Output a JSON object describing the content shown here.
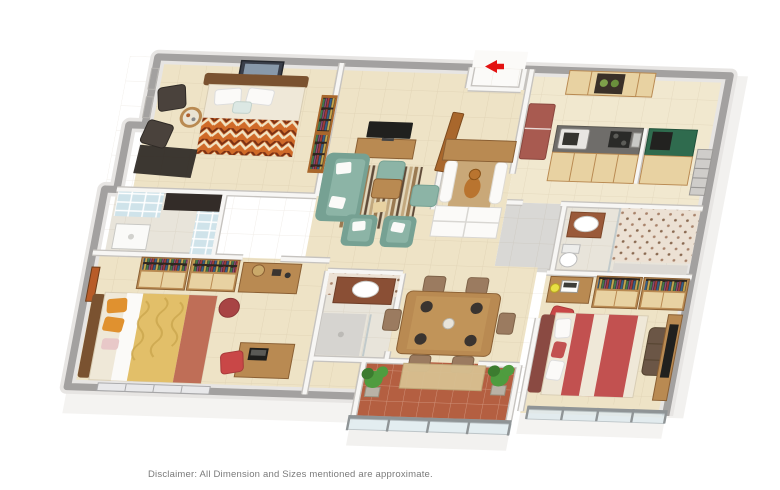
{
  "page": {
    "background": "#ffffff",
    "disclaimer": "Disclaimer: All Dimension and Sizes mentioned are approximate."
  },
  "floorplan": {
    "type": "3d-isometric-floor-plan",
    "entry": {
      "symbol": "red-arrow",
      "direction": "left"
    },
    "rooms": [
      {
        "id": "bedroom-2",
        "furniture": [
          "double-bed",
          "zigzag-blanket",
          "white-pillows",
          "accent-chair",
          "accent-chair",
          "round-side-table",
          "floor-mat",
          "wall-art",
          "window",
          "window",
          "bookshelf"
        ]
      },
      {
        "id": "bedroom-2-bathroom",
        "furniture": [
          "glass-brick-partition",
          "dark-counter",
          "shower-tray"
        ]
      },
      {
        "id": "living-room",
        "furniture": [
          "tv-unit",
          "television",
          "three-seat-sofa",
          "armchair",
          "armchair",
          "ottoman",
          "ottoman",
          "striped-rug",
          "coffee-table",
          "stool",
          "open-door"
        ]
      },
      {
        "id": "foyer",
        "furniture": [
          "entrance-recess",
          "entry-arrow"
        ]
      },
      {
        "id": "pooja-room",
        "furniture": [
          "wooden-canopy",
          "curtain",
          "curtain",
          "deity-idol",
          "drawer-base"
        ]
      },
      {
        "id": "kitchen",
        "furniture": [
          "refrigerator",
          "upper-cabinets",
          "storage-jars",
          "microwave",
          "hob",
          "sink",
          "granite-counter",
          "lower-cabinets"
        ]
      },
      {
        "id": "utility",
        "furniture": [
          "green-counter",
          "appliance",
          "lower-cabinets",
          "service-rack"
        ]
      },
      {
        "id": "bathroom-2",
        "furniture": [
          "vanity-washbasin",
          "toilet",
          "patterned-tiles",
          "shower-area"
        ]
      },
      {
        "id": "common-bathroom",
        "furniture": [
          "vanity-washbasin",
          "patterned-tiles",
          "shower-area",
          "glass-screen"
        ]
      },
      {
        "id": "bedroom-3",
        "furniture": [
          "double-bed",
          "yellow-blanket",
          "red-throw",
          "orange-pillows",
          "wardrobe",
          "wardrobe",
          "dresser",
          "pouf",
          "study-desk",
          "laptop",
          "red-chair",
          "wall-art",
          "window-band"
        ]
      },
      {
        "id": "dining",
        "furniture": [
          "dining-table",
          "dinner-plates",
          "dining-chair",
          "dining-chair",
          "dining-chair",
          "dining-chair",
          "dining-chair",
          "dining-chair"
        ]
      },
      {
        "id": "balcony",
        "furniture": [
          "terracotta-floor",
          "deck-mat",
          "planter",
          "planter",
          "glass-railing"
        ]
      },
      {
        "id": "master-bedroom",
        "furniture": [
          "double-bed",
          "red-blanket",
          "headboard",
          "bench",
          "wardrobe",
          "wardrobe",
          "tv-unit",
          "television",
          "desk",
          "laptop",
          "red-chair",
          "glass-railing"
        ]
      }
    ],
    "colors": {
      "wall-top": "#a3a1a0",
      "floor": "#eee3c6",
      "floor-light": "#f1e8cf",
      "floor-bath": "#e8e4da",
      "floor-gray": "#d9d8d5",
      "balcony-tile": "#b45f41",
      "balcony-mat": "#d8c091",
      "wood": "#b98a52",
      "wood-dark": "#7a5230",
      "wood-light": "#e8d2a2",
      "wood-red": "#a9672c",
      "sofa": "#8cb4a6",
      "sofa-dark": "#76a193",
      "bed-cream": "#efe8d8",
      "bed-orange": "#d06a28",
      "bed-yellow": "#e2bf69",
      "bed-red-throw": "#bf6e57",
      "pillow-orange": "#e0912f",
      "master-bed": "#c25150",
      "fridge": "#a85a50",
      "counter": "#6f6d6a",
      "counter-green": "#2f6b4e",
      "plant": "#4f9c3f",
      "plant-dark": "#3c7c2f",
      "chair-red": "#c94747",
      "dark-chair": "#4a423c",
      "tv": "#20201e",
      "idol": "#b9742f",
      "arrow": "#e31212",
      "text": "#7a7a7a"
    }
  }
}
